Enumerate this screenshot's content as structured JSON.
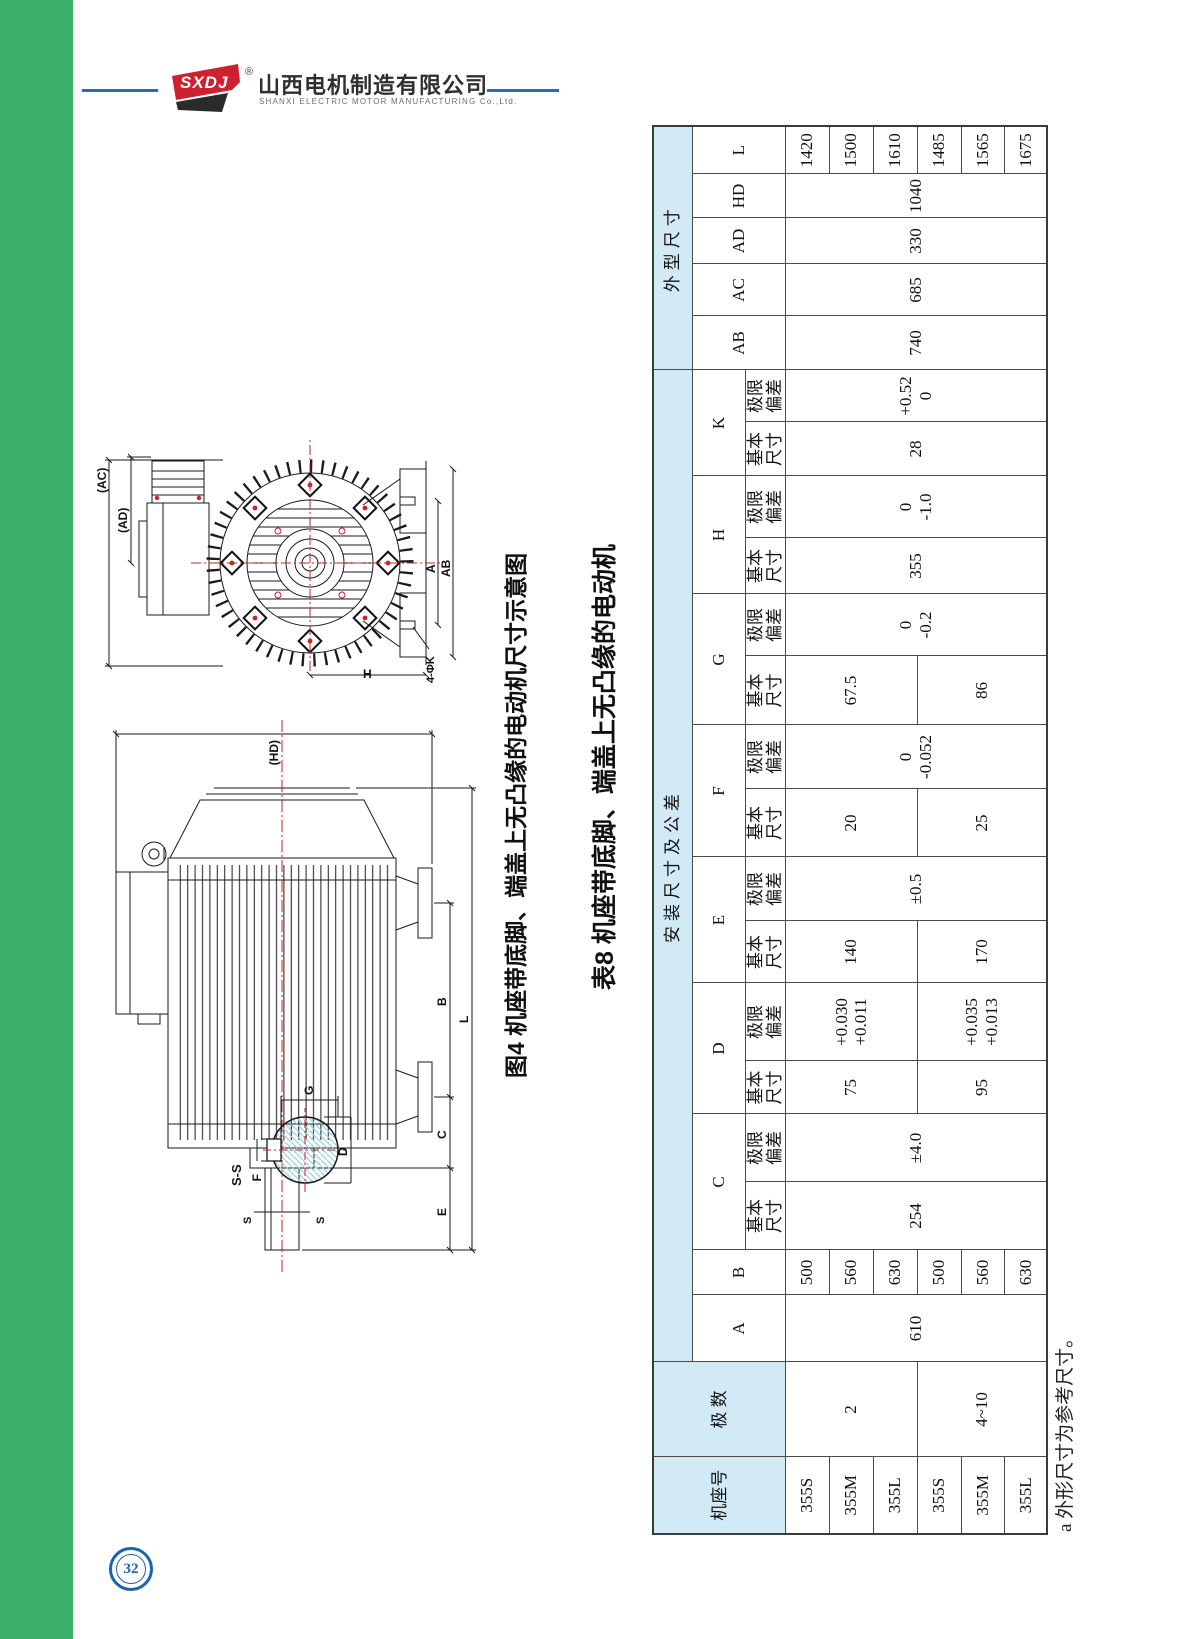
{
  "page": {
    "number": "32"
  },
  "header": {
    "logo_text": "SXDJ",
    "registered": "®",
    "company_cn": "山西电机制造有限公司",
    "company_en": "SHANXI ELECTRIC MOTOR MANUFACTURING Co.,Ltd."
  },
  "figure": {
    "caption": "图4 机座带底脚、端盖上无凸缘的电动机尺寸示意图",
    "end_view": {
      "ac": "(AC)",
      "ad": "(AD)",
      "a": "A",
      "ab": "AB",
      "h": "H",
      "k": "4-ΦK"
    },
    "side_view": {
      "hd": "(HD)",
      "l": "L",
      "b": "B",
      "c": "C",
      "e": "E",
      "s": "S"
    },
    "section": {
      "title": "S-S",
      "f": "F",
      "g": "G",
      "d": "D"
    }
  },
  "table": {
    "caption": "表8 机座带底脚、端盖上无凸缘的电动机",
    "note": "a 外形尺寸为参考尺寸。",
    "headers": {
      "frame": "机座号",
      "poles": "极 数",
      "install_group": "安装尺寸及公差",
      "outline_group": "外型尺寸",
      "basic": [
        "基本",
        "尺寸"
      ],
      "dev": [
        "极限",
        "偏差"
      ],
      "letters": {
        "A": "A",
        "B": "B",
        "C": "C",
        "D": "D",
        "E": "E",
        "F": "F",
        "G": "G",
        "H": "H",
        "K": "K",
        "AB": "AB",
        "AC": "AC",
        "AD": "AD",
        "HD": "HD",
        "L": "L"
      }
    },
    "merged": {
      "A": "610",
      "C_basic": "254",
      "C_dev": "±4.0",
      "E_dev": "±0.5",
      "F_dev": [
        "0",
        "-0.052"
      ],
      "G_dev": [
        "0",
        "-0.2"
      ],
      "H_basic": "355",
      "H_dev": [
        "0",
        "-1.0"
      ],
      "K_basic": "28",
      "K_dev": [
        "+0.52",
        "0"
      ],
      "AB": "740",
      "AC": "685",
      "AD": "330",
      "HD": "1040",
      "poles_2": "2",
      "poles_4to10": "4~10",
      "D_basic_2": "75",
      "D_dev_2": [
        "+0.030",
        "+0.011"
      ],
      "E_basic_2": "140",
      "F_basic_2": "20",
      "G_basic_2": "67.5",
      "D_basic_4": "95",
      "D_dev_4": [
        "+0.035",
        "+0.013"
      ],
      "E_basic_4": "170",
      "F_basic_4": "25",
      "G_basic_4": "86"
    },
    "rows": [
      {
        "frame": "355S",
        "B": "500",
        "L": "1420"
      },
      {
        "frame": "355M",
        "B": "560",
        "L": "1500"
      },
      {
        "frame": "355L",
        "B": "630",
        "L": "1610"
      },
      {
        "frame": "355S",
        "B": "500",
        "L": "1485"
      },
      {
        "frame": "355M",
        "B": "560",
        "L": "1565"
      },
      {
        "frame": "355L",
        "B": "630",
        "L": "1675"
      }
    ]
  },
  "colors": {
    "accent_green": "#3bae6c",
    "accent_blue": "#2a6cb5",
    "table_header_fill": "#d2e9f6",
    "logo_red": "#cf2030",
    "badge_blue": "#1a63ad",
    "hatch_cyan": "#8ed5e8",
    "centerline_red": "#cc2222"
  }
}
